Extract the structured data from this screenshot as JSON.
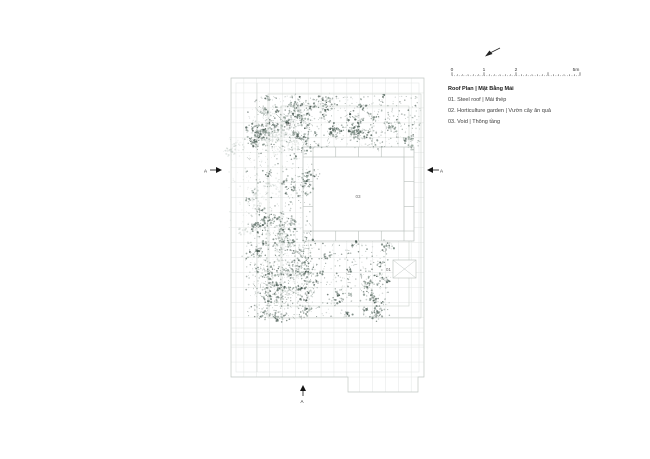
{
  "titleblock": {
    "title": "Roof Plan | Mặt Bằng Mái",
    "legend_items": [
      "01. Steel roof | Mái thép",
      "02. Horticulture garden | Vườn cây ăn quả",
      "03. Void | Thông tầng"
    ]
  },
  "scalebar": {
    "labels": [
      "0",
      "1",
      "2",
      "5m"
    ]
  },
  "plan": {
    "labels": {
      "steel_roof": "01",
      "garden": "02",
      "void": "03"
    },
    "section_markers": {
      "left": "A",
      "right": "A",
      "bottom": "A"
    }
  },
  "colors": {
    "foliage_dark": "#46574f",
    "foliage_light": "#b2bdb7",
    "grid_line": "#e3e6e4",
    "roof_outline": "#c2c9c5",
    "void_frame": "#b7bfbb",
    "text": "#3a3a3a",
    "marker": "#151515"
  }
}
